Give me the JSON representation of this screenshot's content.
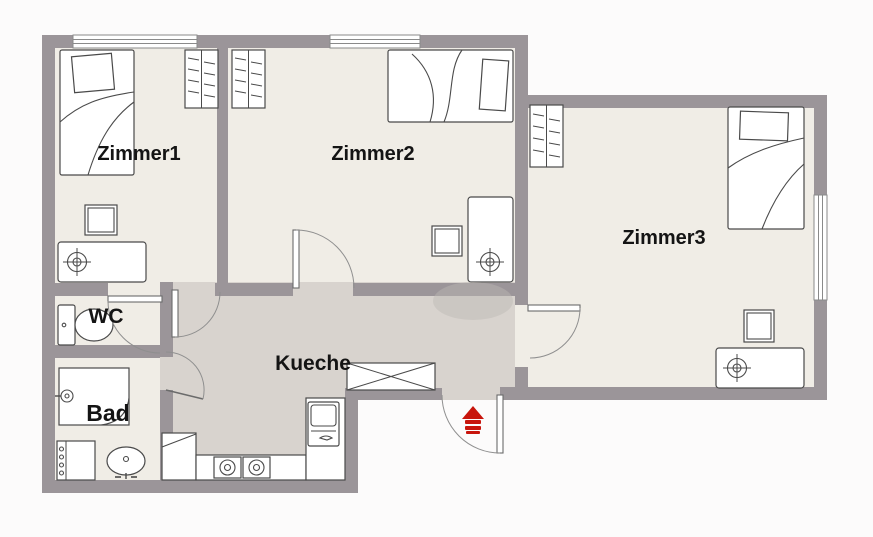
{
  "plan_title": "Apartment floor plan",
  "rooms": [
    {
      "id": "zimmer1",
      "label": "Zimmer1",
      "furniture": [
        "bed",
        "wardrobe",
        "nightstand",
        "desk"
      ]
    },
    {
      "id": "zimmer2",
      "label": "Zimmer2",
      "furniture": [
        "bed",
        "wardrobe",
        "chair",
        "desk"
      ]
    },
    {
      "id": "zimmer3",
      "label": "Zimmer3",
      "furniture": [
        "bed",
        "wardrobe",
        "stool",
        "desk"
      ]
    },
    {
      "id": "wc",
      "label": "WC",
      "furniture": [
        "toilet"
      ]
    },
    {
      "id": "bad",
      "label": "Bad",
      "furniture": [
        "shower",
        "washing-machine",
        "sink"
      ]
    },
    {
      "id": "kueche",
      "label": "Kueche",
      "furniture": [
        "table",
        "counter",
        "stove",
        "kitchen-sink",
        "fridge"
      ]
    }
  ],
  "icons": [
    {
      "name": "entrance-marker-icon",
      "meaning": "main entrance",
      "color": "#c8150c"
    }
  ],
  "colors": {
    "wall": "#9b9599",
    "room_floor": "#f0ede6",
    "hall_floor": "#d8d3ce",
    "exterior": "#fcfbfb",
    "outline": "#4a4a4a",
    "accent_red": "#c8150c",
    "label_text": "#141414"
  }
}
